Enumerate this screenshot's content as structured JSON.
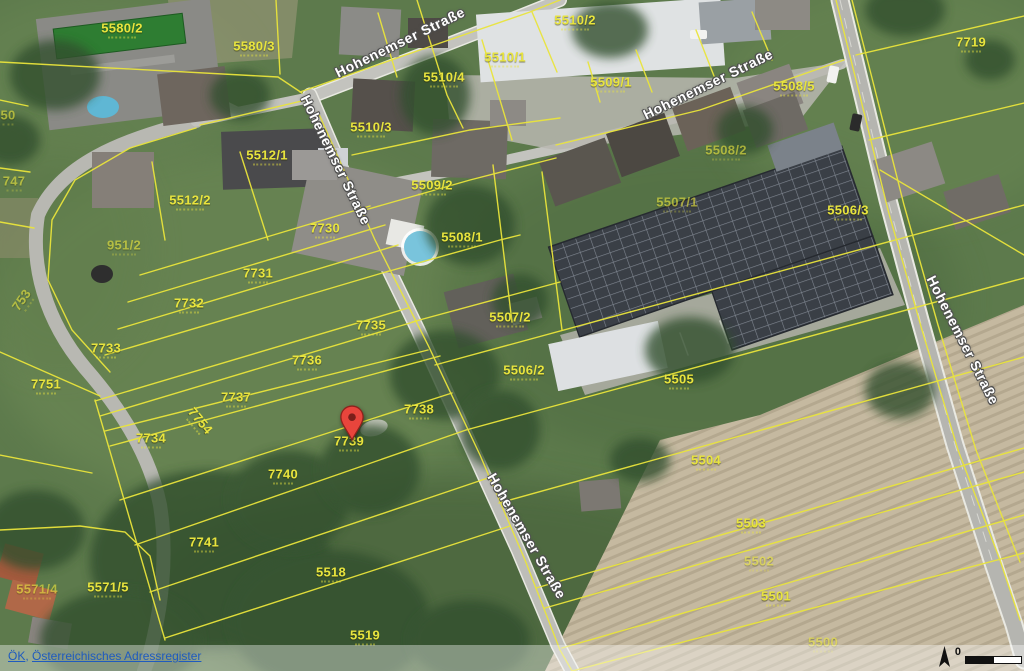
{
  "street_name": "Hohenemser Straße",
  "attribution": {
    "links": [
      "ÖK",
      "Österreichisches Adressregister"
    ],
    "separator": ", "
  },
  "scale": {
    "zero_label": "0"
  },
  "marker": {
    "x": 352,
    "y": 441,
    "color": "#e8453c"
  },
  "colors": {
    "parcel_line": "#e9e43b",
    "parcel_text": "#e8e43e",
    "street_text": "#ffffff",
    "street_halo": "#4f4f4f",
    "attribution_link": "#1f5bbf",
    "field_tan": "#c6baa2",
    "grass_green": "#5d7a4c"
  },
  "street_labels": [
    {
      "text": "Hohenemser Straße",
      "x": 400,
      "y": 42,
      "rot": -26
    },
    {
      "text": "Hohenemser Straße",
      "x": 336,
      "y": 160,
      "rot": 64
    },
    {
      "text": "Hohenemser Straße",
      "x": 708,
      "y": 84,
      "rot": -26
    },
    {
      "text": "Hohenemser Straße",
      "x": 963,
      "y": 340,
      "rot": 63
    },
    {
      "text": "Hohenemser Straße",
      "x": 527,
      "y": 536,
      "rot": 60
    }
  ],
  "parcel_labels": [
    {
      "text": "5580/2",
      "x": 122,
      "y": 30
    },
    {
      "text": "5580/3",
      "x": 254,
      "y": 48
    },
    {
      "text": "5510/2",
      "x": 575,
      "y": 22
    },
    {
      "text": "5510/1",
      "x": 505,
      "y": 59
    },
    {
      "text": "5510/4",
      "x": 444,
      "y": 79
    },
    {
      "text": "5509/1",
      "x": 611,
      "y": 84
    },
    {
      "text": "5508/5",
      "x": 794,
      "y": 88
    },
    {
      "text": "5510/3",
      "x": 371,
      "y": 129
    },
    {
      "text": "5512/1",
      "x": 267,
      "y": 157
    },
    {
      "text": "5508/2",
      "x": 726,
      "y": 152,
      "faint": true
    },
    {
      "text": "5509/2",
      "x": 432,
      "y": 187
    },
    {
      "text": "5512/2",
      "x": 190,
      "y": 202
    },
    {
      "text": "5507/1",
      "x": 677,
      "y": 204,
      "faint": true
    },
    {
      "text": "5506/3",
      "x": 848,
      "y": 212
    },
    {
      "text": "7730",
      "x": 325,
      "y": 230
    },
    {
      "text": "951/2",
      "x": 124,
      "y": 247,
      "faint": true
    },
    {
      "text": "5508/1",
      "x": 462,
      "y": 239
    },
    {
      "text": "7731",
      "x": 258,
      "y": 275
    },
    {
      "text": "7732",
      "x": 189,
      "y": 305
    },
    {
      "text": "5507/2",
      "x": 510,
      "y": 319
    },
    {
      "text": "7733",
      "x": 106,
      "y": 350
    },
    {
      "text": "7735",
      "x": 371,
      "y": 327
    },
    {
      "text": "7736",
      "x": 307,
      "y": 362
    },
    {
      "text": "5506/2",
      "x": 524,
      "y": 372
    },
    {
      "text": "5505",
      "x": 679,
      "y": 381
    },
    {
      "text": "7751",
      "x": 46,
      "y": 386
    },
    {
      "text": "7737",
      "x": 236,
      "y": 399
    },
    {
      "text": "7754",
      "x": 199,
      "y": 422,
      "rot": 50
    },
    {
      "text": "7738",
      "x": 419,
      "y": 411
    },
    {
      "text": "7739",
      "x": 349,
      "y": 443
    },
    {
      "text": "7734",
      "x": 151,
      "y": 440
    },
    {
      "text": "5504",
      "x": 706,
      "y": 462
    },
    {
      "text": "7740",
      "x": 283,
      "y": 476
    },
    {
      "text": "5503",
      "x": 751,
      "y": 525
    },
    {
      "text": "7741",
      "x": 204,
      "y": 544
    },
    {
      "text": "5502",
      "x": 759,
      "y": 563,
      "faint": true
    },
    {
      "text": "5518",
      "x": 331,
      "y": 574
    },
    {
      "text": "5571/4",
      "x": 37,
      "y": 591,
      "faint": true
    },
    {
      "text": "5571/5",
      "x": 108,
      "y": 589
    },
    {
      "text": "5501",
      "x": 776,
      "y": 598
    },
    {
      "text": "5519",
      "x": 365,
      "y": 637
    },
    {
      "text": "5500",
      "x": 823,
      "y": 644,
      "faint": true
    },
    {
      "text": "7719",
      "x": 971,
      "y": 44
    },
    {
      "text": "50",
      "x": 8,
      "y": 117,
      "faint": true
    },
    {
      "text": "747",
      "x": 14,
      "y": 183,
      "faint": true
    },
    {
      "text": "753",
      "x": 23,
      "y": 301,
      "rot": -55,
      "faint": true
    }
  ]
}
